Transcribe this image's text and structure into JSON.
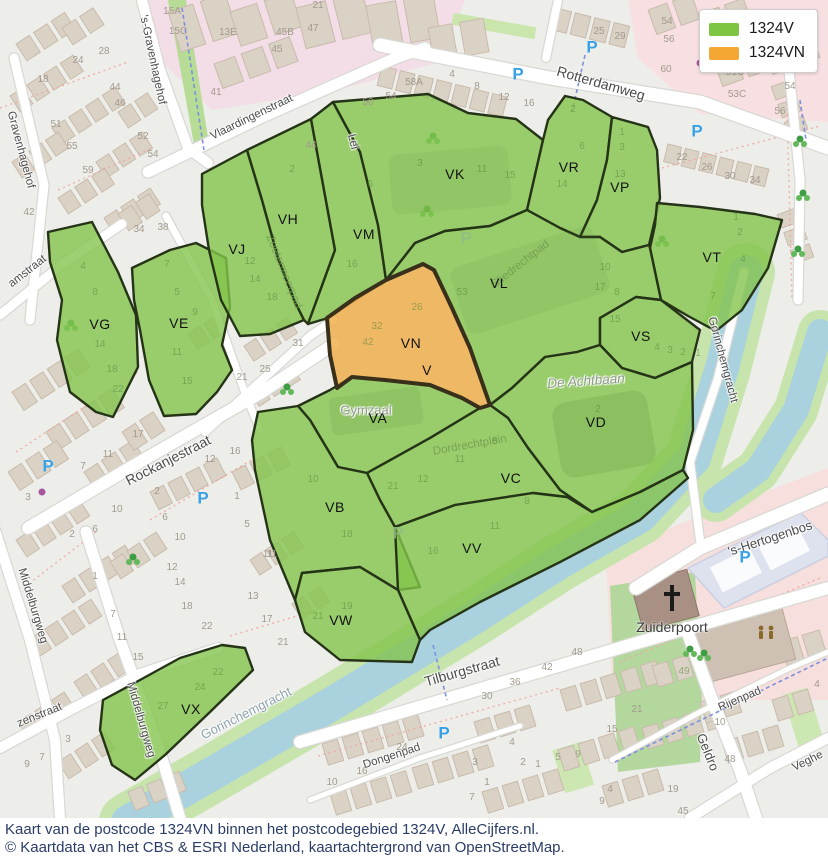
{
  "legend": {
    "items": [
      {
        "label": "1324V",
        "color": "#7dc542"
      },
      {
        "label": "1324VN",
        "color": "#f5a733"
      }
    ]
  },
  "caption": {
    "line1": "Kaart van de postcode 1324VN binnen het postcodegebied 1324V, AlleCijfers.nl.",
    "line2": "© Kaartdata van het CBS & ESRI Nederland, kaartachtergrond van OpenStreetMap."
  },
  "colors": {
    "region_fill": "#83c44c",
    "region_stroke": "#253317",
    "selected_fill": "#f0a93f",
    "selected_stroke": "#38301a",
    "water": "#a9d2de",
    "water_bank": "#c7e4ad",
    "caption_text": "#2b3d66",
    "parking_blue": "#38a0e4"
  },
  "map": {
    "icons": {
      "parking_glyph": "P"
    },
    "region_labels": [
      {
        "t": "VK",
        "x": 455,
        "y": 174
      },
      {
        "t": "VR",
        "x": 569,
        "y": 167
      },
      {
        "t": "VP",
        "x": 620,
        "y": 187
      },
      {
        "t": "VH",
        "x": 288,
        "y": 219
      },
      {
        "t": "VJ",
        "x": 237,
        "y": 249
      },
      {
        "t": "VM",
        "x": 364,
        "y": 234
      },
      {
        "t": "VL",
        "x": 499,
        "y": 283
      },
      {
        "t": "VT",
        "x": 712,
        "y": 257
      },
      {
        "t": "VG",
        "x": 100,
        "y": 324
      },
      {
        "t": "VE",
        "x": 179,
        "y": 323
      },
      {
        "t": "VN",
        "x": 411,
        "y": 343
      },
      {
        "t": "V",
        "x": 427,
        "y": 370
      },
      {
        "t": "VS",
        "x": 641,
        "y": 336
      },
      {
        "t": "VA",
        "x": 378,
        "y": 418
      },
      {
        "t": "VD",
        "x": 596,
        "y": 422
      },
      {
        "t": "VC",
        "x": 511,
        "y": 478
      },
      {
        "t": "VB",
        "x": 335,
        "y": 507
      },
      {
        "t": "VV",
        "x": 472,
        "y": 548
      },
      {
        "t": "VW",
        "x": 341,
        "y": 620
      },
      {
        "t": "VX",
        "x": 191,
        "y": 709
      }
    ],
    "street_labels": [
      {
        "t": "'s-Gravenhagehof",
        "x": 152,
        "y": 60,
        "r": 78
      },
      {
        "t": "Gravenhagehof",
        "x": 20,
        "y": 150,
        "r": 75
      },
      {
        "t": "amstraat",
        "x": 28,
        "y": 272,
        "r": -38
      },
      {
        "t": "Vlaardingenstraat",
        "x": 252,
        "y": 118,
        "r": -26
      },
      {
        "t": "Rotterdamweg",
        "x": 601,
        "y": 83,
        "r": 16,
        "s": 14
      },
      {
        "t": "Lei",
        "x": 352,
        "y": 142,
        "r": 75
      },
      {
        "t": "Zoetermeerpad",
        "x": 283,
        "y": 272,
        "r": 68,
        "c": "grn"
      },
      {
        "t": "Sliedrechtpad",
        "x": 521,
        "y": 265,
        "r": -38,
        "c": "grn"
      },
      {
        "t": "Rockanjestraat",
        "x": 168,
        "y": 460,
        "r": -27,
        "s": 14
      },
      {
        "t": "Middelburgweg",
        "x": 32,
        "y": 606,
        "r": 73
      },
      {
        "t": "Middelburgweg",
        "x": 140,
        "y": 720,
        "r": 74
      },
      {
        "t": "zenstraat",
        "x": 40,
        "y": 716,
        "r": -22
      },
      {
        "t": "Tilburgstraat",
        "x": 462,
        "y": 671,
        "r": -16,
        "s": 14
      },
      {
        "t": "Dongenpad",
        "x": 392,
        "y": 757,
        "r": -18
      },
      {
        "t": "Gorinchemgracht",
        "x": 246,
        "y": 713,
        "r": -27,
        "c": "wt",
        "s": 13
      },
      {
        "t": "Gorinchemgracht",
        "x": 722,
        "y": 360,
        "r": 75
      },
      {
        "t": "'s-Hertogenbos",
        "x": 770,
        "y": 538,
        "r": -18,
        "s": 13
      },
      {
        "t": "Rijenpad",
        "x": 740,
        "y": 700,
        "r": -23
      },
      {
        "t": "Veghe",
        "x": 808,
        "y": 762,
        "r": -26
      },
      {
        "t": "Geldro",
        "x": 708,
        "y": 752,
        "r": 68,
        "s": 13
      }
    ],
    "poi_labels": [
      {
        "t": "Gymzaal",
        "x": 366,
        "y": 410,
        "c": "poi"
      },
      {
        "t": "De Achtbaan",
        "x": 586,
        "y": 381,
        "r": -4,
        "c": "poi-it"
      },
      {
        "t": "Zuiderpoort",
        "x": 672,
        "y": 627,
        "c": "poi-dk"
      },
      {
        "t": "Dordrechtplein",
        "x": 470,
        "y": 446,
        "r": -10,
        "c": "grn"
      }
    ],
    "house_numbers": [
      [
        "15A",
        172,
        12
      ],
      [
        "15C",
        178,
        32
      ],
      [
        "13E",
        228,
        33
      ],
      [
        "45B",
        285,
        33
      ],
      [
        "47",
        313,
        29
      ],
      [
        "45",
        277,
        50
      ],
      [
        "41",
        216,
        93
      ],
      [
        "24",
        78,
        61
      ],
      [
        "28",
        104,
        52
      ],
      [
        "18",
        43,
        80
      ],
      [
        "44",
        115,
        88
      ],
      [
        "46",
        120,
        104
      ],
      [
        "51",
        56,
        125
      ],
      [
        "55",
        72,
        147
      ],
      [
        "52",
        143,
        137
      ],
      [
        "54",
        153,
        155
      ],
      [
        "59",
        88,
        171
      ],
      [
        "44",
        311,
        146
      ],
      [
        "34",
        139,
        230
      ],
      [
        "38",
        163,
        228
      ],
      [
        "42",
        29,
        213
      ],
      [
        "21",
        318,
        6
      ],
      [
        "50",
        368,
        103
      ],
      [
        "54",
        391,
        97
      ],
      [
        "58A",
        414,
        83
      ],
      [
        "4",
        452,
        75
      ],
      [
        "8",
        477,
        87
      ],
      [
        "12",
        504,
        98
      ],
      [
        "16",
        529,
        104
      ],
      [
        "25",
        599,
        32
      ],
      [
        "29",
        620,
        37
      ],
      [
        "54",
        667,
        22
      ],
      [
        "56",
        669,
        40
      ],
      [
        "60",
        666,
        70
      ],
      [
        "51C",
        735,
        73
      ],
      [
        "53C",
        737,
        95
      ],
      [
        "52",
        798,
        68
      ],
      [
        "54",
        790,
        87
      ],
      [
        "56",
        780,
        112
      ],
      [
        "22",
        682,
        158
      ],
      [
        "26",
        707,
        168
      ],
      [
        "30",
        730,
        177
      ],
      [
        "34",
        755,
        181
      ],
      [
        "31",
        298,
        344
      ],
      [
        "25",
        265,
        370
      ],
      [
        "21",
        242,
        378
      ],
      [
        "17",
        138,
        435
      ],
      [
        "11",
        108,
        455
      ],
      [
        "7",
        83,
        467
      ],
      [
        "3",
        28,
        498
      ],
      [
        "2",
        157,
        492
      ],
      [
        "10",
        117,
        510
      ],
      [
        "6",
        165,
        518
      ],
      [
        "10",
        180,
        538
      ],
      [
        "2",
        72,
        535
      ],
      [
        "6",
        95,
        530
      ],
      [
        "12",
        210,
        460
      ],
      [
        "16",
        235,
        452
      ],
      [
        "1",
        237,
        497
      ],
      [
        "5",
        247,
        525
      ],
      [
        "11",
        268,
        555
      ],
      [
        "12",
        172,
        568
      ],
      [
        "14",
        180,
        583
      ],
      [
        "18",
        187,
        607
      ],
      [
        "22",
        207,
        627
      ],
      [
        "1",
        95,
        577
      ],
      [
        "7",
        113,
        615
      ],
      [
        "11",
        122,
        638
      ],
      [
        "15",
        138,
        658
      ],
      [
        "11",
        272,
        555
      ],
      [
        "13",
        253,
        597
      ],
      [
        "17",
        267,
        620
      ],
      [
        "21",
        283,
        643
      ],
      [
        "3",
        68,
        740
      ],
      [
        "7",
        42,
        758
      ],
      [
        "9",
        27,
        765
      ],
      [
        "10",
        332,
        783
      ],
      [
        "16",
        362,
        772
      ],
      [
        "24",
        402,
        748
      ],
      [
        "30",
        487,
        697
      ],
      [
        "36",
        515,
        683
      ],
      [
        "42",
        547,
        668
      ],
      [
        "48",
        577,
        653
      ],
      [
        "3",
        475,
        763
      ],
      [
        "1",
        487,
        783
      ],
      [
        "7",
        472,
        798
      ],
      [
        "4",
        512,
        743
      ],
      [
        "2",
        523,
        763
      ],
      [
        "1",
        538,
        765
      ],
      [
        "5",
        558,
        758
      ],
      [
        "9",
        578,
        755
      ],
      [
        "15",
        612,
        730
      ],
      [
        "9",
        602,
        802
      ],
      [
        "4",
        610,
        790
      ],
      [
        "10",
        720,
        723
      ],
      [
        "48",
        730,
        760
      ],
      [
        "45",
        683,
        812
      ],
      [
        "19",
        673,
        790
      ],
      [
        "4",
        817,
        685
      ],
      [
        "21",
        637,
        710
      ]
    ],
    "house_numbers_green": [
      [
        "3",
        420,
        164
      ],
      [
        "11",
        482,
        170
      ],
      [
        "15",
        510,
        176
      ],
      [
        "2",
        573,
        110
      ],
      [
        "6",
        582,
        147
      ],
      [
        "14",
        562,
        185
      ],
      [
        "1",
        622,
        133
      ],
      [
        "3",
        622,
        148
      ],
      [
        "13",
        620,
        175
      ],
      [
        "10",
        605,
        268
      ],
      [
        "17",
        600,
        288
      ],
      [
        "8",
        617,
        293
      ],
      [
        "15",
        615,
        320
      ],
      [
        "1",
        736,
        218
      ],
      [
        "2",
        740,
        233
      ],
      [
        "4",
        743,
        260
      ],
      [
        "7",
        713,
        297
      ],
      [
        "6",
        370,
        185
      ],
      [
        "16",
        352,
        265
      ],
      [
        "12",
        250,
        262
      ],
      [
        "14",
        255,
        280
      ],
      [
        "18",
        272,
        298
      ],
      [
        "2",
        292,
        170
      ],
      [
        "4",
        83,
        267
      ],
      [
        "8",
        95,
        293
      ],
      [
        "14",
        100,
        345
      ],
      [
        "18",
        112,
        370
      ],
      [
        "22",
        118,
        390
      ],
      [
        "7",
        167,
        265
      ],
      [
        "5",
        177,
        293
      ],
      [
        "9",
        195,
        313
      ],
      [
        "11",
        177,
        353
      ],
      [
        "15",
        187,
        382
      ],
      [
        "26",
        417,
        308
      ],
      [
        "32",
        377,
        327
      ],
      [
        "42",
        368,
        343
      ],
      [
        "53",
        462,
        293
      ],
      [
        "4",
        657,
        348
      ],
      [
        "3",
        670,
        351
      ],
      [
        "2",
        683,
        353
      ],
      [
        "1",
        698,
        354
      ],
      [
        "2",
        598,
        410
      ],
      [
        "12",
        423,
        480
      ],
      [
        "21",
        393,
        487
      ],
      [
        "11",
        460,
        460
      ],
      [
        "5",
        495,
        442
      ],
      [
        "16",
        433,
        552
      ],
      [
        "11",
        495,
        527
      ],
      [
        "8",
        527,
        502
      ],
      [
        "10",
        313,
        480
      ],
      [
        "18",
        347,
        535
      ],
      [
        "19",
        347,
        607
      ],
      [
        "21",
        318,
        617
      ],
      [
        "22",
        218,
        673
      ],
      [
        "24",
        200,
        688
      ],
      [
        "27",
        163,
        707
      ],
      [
        "49",
        684,
        672
      ]
    ],
    "parking": {
      "blue": [
        [
          518,
          74
        ],
        [
          592,
          47
        ],
        [
          697,
          131
        ],
        [
          48,
          466
        ],
        [
          203,
          498
        ],
        [
          444,
          733
        ],
        [
          745,
          557
        ]
      ],
      "pale": [
        [
          466,
          238
        ],
        [
          398,
          533
        ]
      ]
    }
  }
}
